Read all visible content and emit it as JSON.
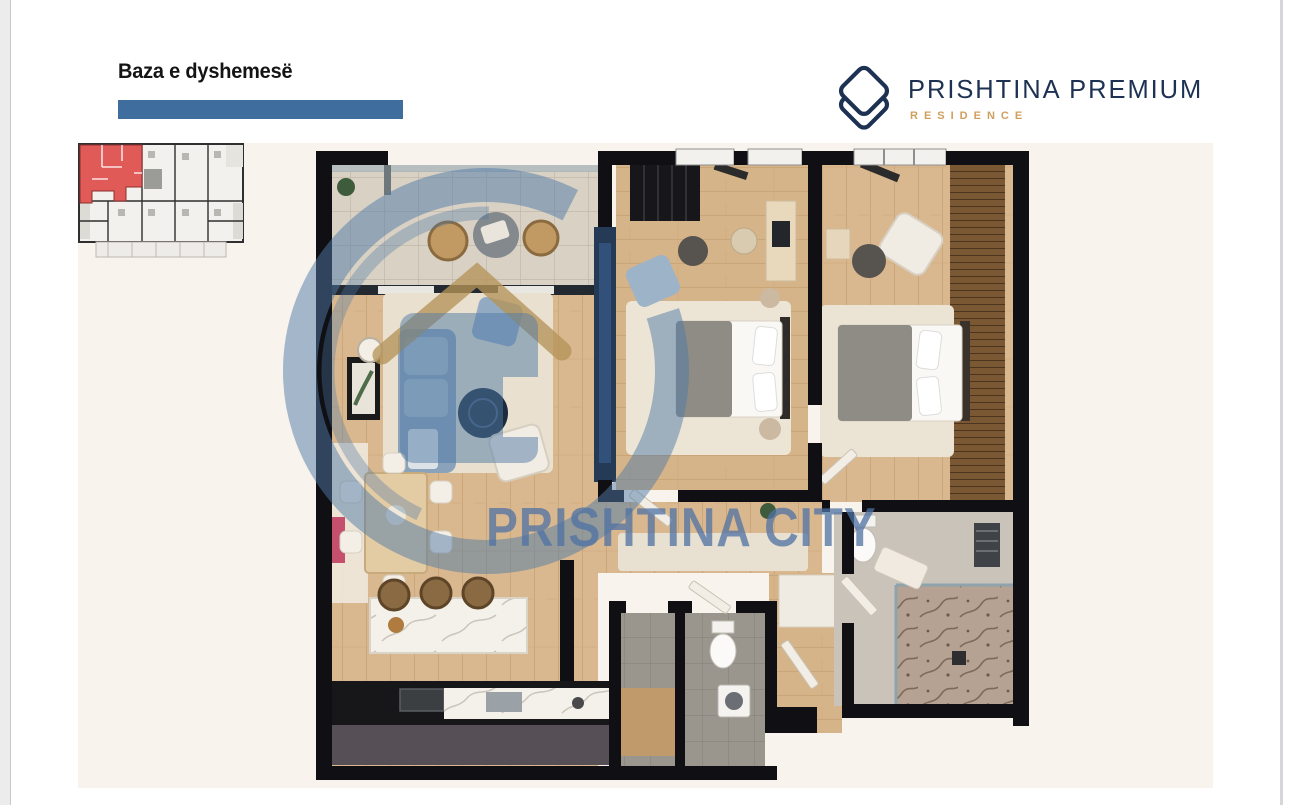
{
  "page": {
    "title": "Baza e dyshemesë"
  },
  "brand": {
    "name": "PRISHTINA PREMIUM",
    "subtitle": "RESIDENCE",
    "logo_icon": "stacked-diamonds-building-icon"
  },
  "watermark": {
    "text": "PRISHTINA CITY",
    "logo_icon": "circle-house-icon"
  },
  "inset": {
    "icon": "key-plan-highlighted-unit"
  },
  "colors": {
    "accent_bar": "#3F6D9E",
    "brand_navy": "#1D3152",
    "brand_gold": "#CF9F5E",
    "watermark_blue": "#4F79A5",
    "highlight_red": "#E05A57",
    "wall_black": "#101014",
    "floor_wood": "#D9B88F",
    "plan_bg": "#F8F3EC"
  }
}
